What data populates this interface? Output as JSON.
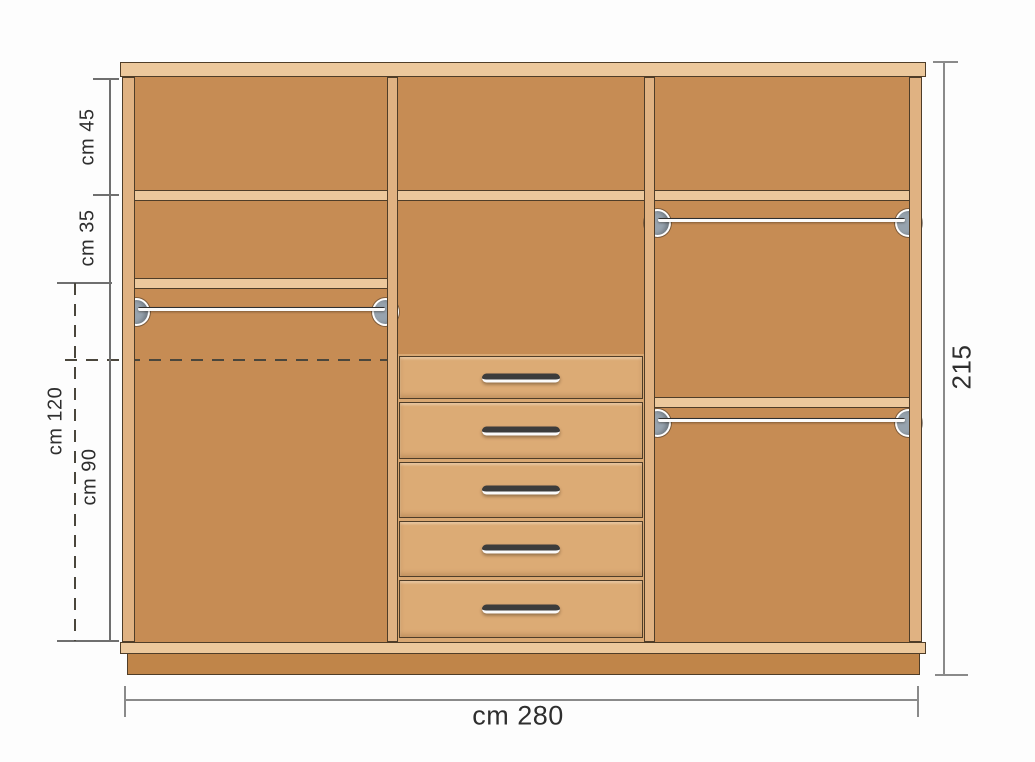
{
  "diagram": {
    "kind": "wardrobe front elevation with internal layout",
    "unit": "cm"
  },
  "labels": {
    "top_shelf_height": "cm 45",
    "second_shelf_height": "cm 35",
    "lower_left_total_height": "cm 120",
    "hanging_space_height": "cm 90",
    "overall_height": "215",
    "overall_width": "cm 280"
  },
  "cabinet": {
    "sections": [
      {
        "name": "left",
        "contents": [
          "top shelf compartment",
          "second shelf compartment",
          "hanging rail",
          "open space"
        ]
      },
      {
        "name": "middle",
        "contents": [
          "top shelf compartment",
          "open space",
          "5 drawers"
        ]
      },
      {
        "name": "right",
        "contents": [
          "top shelf compartment",
          "hanging rail",
          "shelf",
          "hanging rail",
          "open space"
        ]
      }
    ],
    "drawer_count": 5,
    "hanging_rail_count": 3
  },
  "colors": {
    "wood_light": "#ecc89c",
    "wood_stile": "#e0b282",
    "wood_interior": "#c68c54",
    "wood_drawer": "#dcab75",
    "wood_plinth": "#c08549",
    "outline": "#4f3d28",
    "dim_line": "#8a8a8a",
    "text": "#2e2e2e",
    "handle": "#3c3c3c",
    "bracket": "#97a3ae"
  }
}
